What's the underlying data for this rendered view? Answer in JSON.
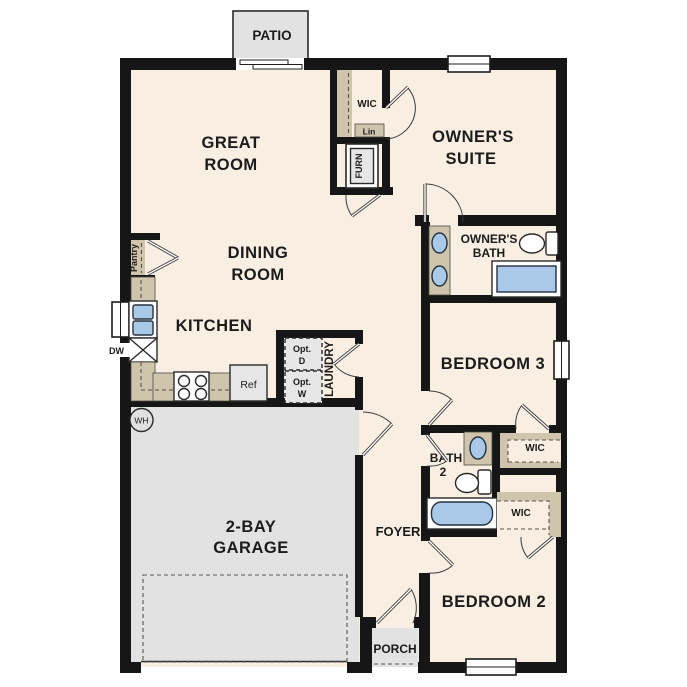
{
  "colors": {
    "wall": "#161616",
    "floor": "#f8efe2",
    "outdoor": "#e2e2e2",
    "tan": "#cfc4ac",
    "blue": "#aac9e8",
    "appliance": "#e6e6e6",
    "text": "#1b1b1b"
  },
  "rooms": {
    "patio": {
      "label": "PATIO"
    },
    "great_room": {
      "label": [
        "GREAT",
        "ROOM"
      ]
    },
    "owners_suite": {
      "label": [
        "OWNER'S",
        "SUITE"
      ]
    },
    "owners_wic": {
      "label": "WIC"
    },
    "linen": {
      "label": "Lin"
    },
    "furnace": {
      "label": "FURN"
    },
    "owners_bath": {
      "label": [
        "OWNER'S",
        "BATH"
      ]
    },
    "dining_room": {
      "label": [
        "DINING",
        "ROOM"
      ]
    },
    "kitchen": {
      "label": "KITCHEN",
      "pantry": "Pantry",
      "dishwasher": "DW",
      "refrigerator": "Ref"
    },
    "laundry": {
      "label": "LAUNDRY",
      "optional_dryer": [
        "Opt.",
        "D"
      ],
      "optional_washer": [
        "Opt.",
        "W"
      ]
    },
    "bedroom3": {
      "label": "BEDROOM 3",
      "wic": "WIC"
    },
    "bath2": {
      "label": [
        "BATH",
        "2"
      ]
    },
    "bedroom2": {
      "label": "BEDROOM 2",
      "wic": "WIC"
    },
    "garage": {
      "label": [
        "2-BAY",
        "GARAGE"
      ],
      "water_heater": "WH"
    },
    "foyer": {
      "label": "FOYER"
    },
    "porch": {
      "label": "PORCH"
    }
  }
}
